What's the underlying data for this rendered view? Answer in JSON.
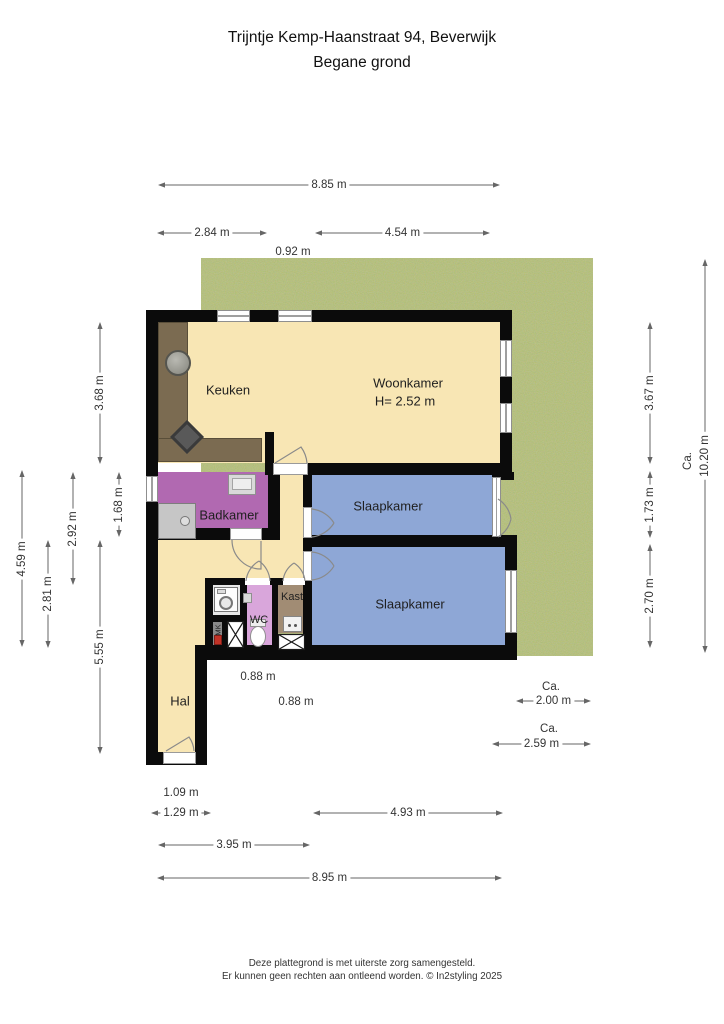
{
  "title": {
    "line1": "Trijntje Kemp-Haanstraat 94, Beverwijk",
    "line2": "Begane grond"
  },
  "rooms": {
    "keuken": "Keuken",
    "woonkamer": "Woonkamer",
    "woonkamer_ceiling_height": "H= 2.52 m",
    "badkamer": "Badkamer",
    "slaapkamer_1": "Slaapkamer",
    "slaapkamer_2": "Slaapkamer",
    "wc": "WC",
    "kast": "Kast",
    "mk": "MK",
    "hal": "Hal"
  },
  "dimensions": {
    "top_total": "8.85 m",
    "top_keuken": "2.84 m",
    "top_woonkamer": "4.54 m",
    "top_window": "0.92 m",
    "left_keuken": "3.68 m",
    "left_badkamer": "1.68 m",
    "left_mid": "2.92 m",
    "left_back": "4.59 m",
    "left_lower": "2.81 m",
    "left_hal": "5.55 m",
    "right_woonkamer": "3.67 m",
    "right_slaapkamer_1": "1.73 m",
    "right_slaapkamer_2": "2.70 m",
    "right_garden_ca": "Ca.",
    "right_garden": "10.20 m",
    "bottom_porch": "1.09 m",
    "bottom_entry": "1.29 m",
    "bottom_slaapkamer": "4.93 m",
    "bottom_left": "3.95 m",
    "bottom_total": "8.95 m",
    "hall_width_a": "0.88 m",
    "hall_width_b": "0.88 m",
    "garden_side_ca": "Ca.",
    "garden_side": "2.00 m",
    "garden_back_ca": "Ca.",
    "garden_back": "2.59 m"
  },
  "footer": {
    "line1": "Deze plattegrond is met uiterste zorg samengesteld.",
    "line2": "Er kunnen geen rechten aan ontleend worden. © In2styling 2025"
  },
  "legend_colors": {
    "wall": "#0b0b0b",
    "living_floor": "#f8e6b4",
    "bedroom": "#8ea7d6",
    "bathroom": "#b169b1",
    "wc": "#d9a6db",
    "closet": "#a18c74",
    "kitchen_counter": "#7b6b51",
    "garden": "#75873c"
  }
}
